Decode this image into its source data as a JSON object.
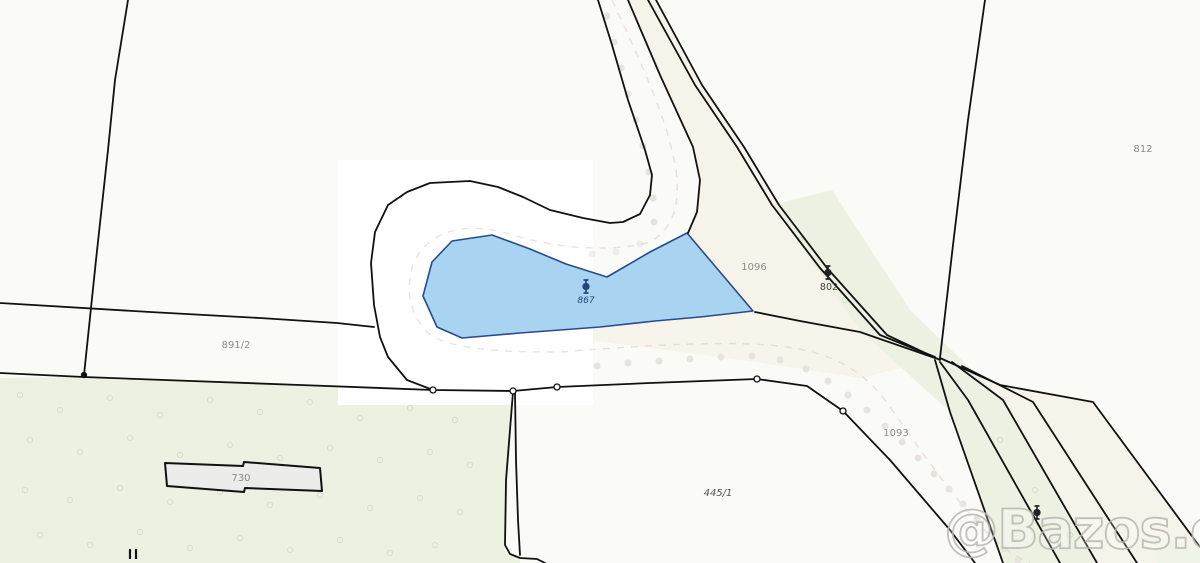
{
  "map": {
    "type": "cadastral-map",
    "watermark": "@Bazos.cz",
    "parcels": [
      {
        "label": "891/2"
      },
      {
        "label": "730"
      },
      {
        "label": "445/1"
      },
      {
        "label": "1096"
      },
      {
        "label": "1093"
      },
      {
        "label": "812"
      },
      {
        "label": "802"
      },
      {
        "label": "867"
      }
    ],
    "colors": {
      "background": "#fafaf7",
      "highlight_rect": "#ffffff",
      "road_fill": "#f6f3ea",
      "green_fill": "#edf1e2",
      "green_fill_light": "#f0f3e7",
      "water_fill": "#a9d4f1",
      "water_stroke": "#2a4a8a",
      "boundary_stroke": "#111111",
      "building_fill": "#ececea",
      "label_gray": "#8b8b89",
      "label_dark": "#555555",
      "label_navy": "#27427c",
      "dashed_road": "#dcc9c2",
      "dot_gray": "#e6e4dc",
      "green_symbol": "#d9dfc9",
      "watermark_stroke": "#b9b7b1"
    }
  }
}
